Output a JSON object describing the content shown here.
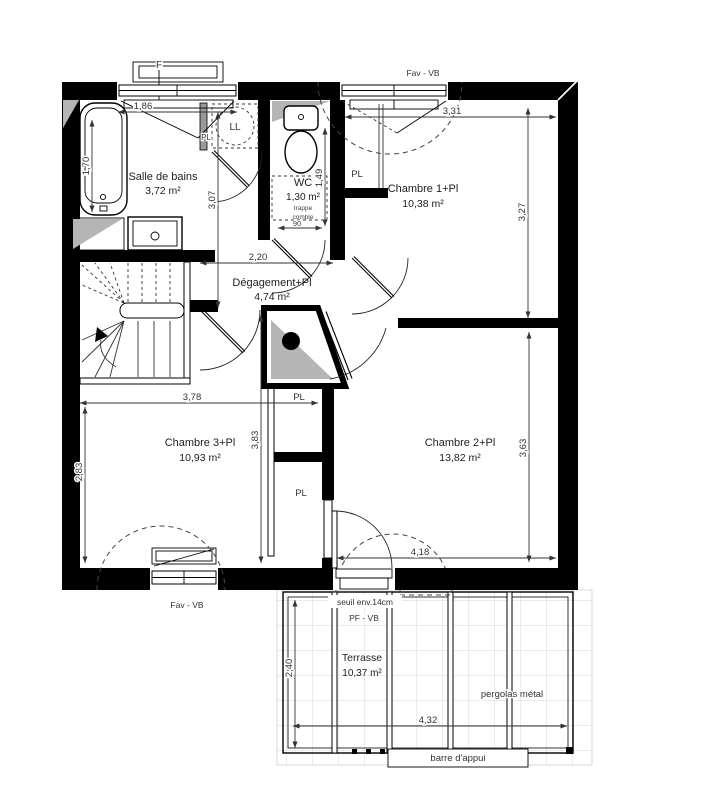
{
  "rooms": [
    {
      "name": "Salle de bains",
      "area": "3,72 m²"
    },
    {
      "name": "WC",
      "area": "1,30 m²"
    },
    {
      "name": "Chambre 1+Pl",
      "area": "10,38 m²"
    },
    {
      "name": "Dégagement+Pl",
      "area": "4,74 m²"
    },
    {
      "name": "Chambre 3+Pl",
      "area": "10,93 m²"
    },
    {
      "name": "Chambre 2+Pl",
      "area": "13,82 m²"
    },
    {
      "name": "Terrasse",
      "area": "10,37 m²"
    }
  ],
  "dims": {
    "d186": "1,86",
    "d170": "1,70",
    "d307": "3,07",
    "d149": "1,49",
    "d331": "3,31",
    "d327": "3,27",
    "d220": "2,20",
    "d378": "3,78",
    "d283": "2,83",
    "d383": "3,83",
    "d363": "3,63",
    "d418": "4,18",
    "d240": "2,40",
    "d432": "4,32",
    "d90": "90"
  },
  "labels": {
    "window_f": "F",
    "window_fav_top": "Fav  -  VB",
    "window_fav_bottom": "Fav  -  VB",
    "door_terrace": "PF  -  VB",
    "seuil": "seuil env.14cm",
    "pergola": "pergolas métal",
    "barre": "barre d'appui",
    "washing_machine": "LL",
    "closet": "PL",
    "trappe_line1": "trappe",
    "trappe_line2": "comble"
  },
  "colors": {
    "wall": "#000000",
    "hatch_gray": "#b5b5b5",
    "dim_line": "#333333"
  }
}
